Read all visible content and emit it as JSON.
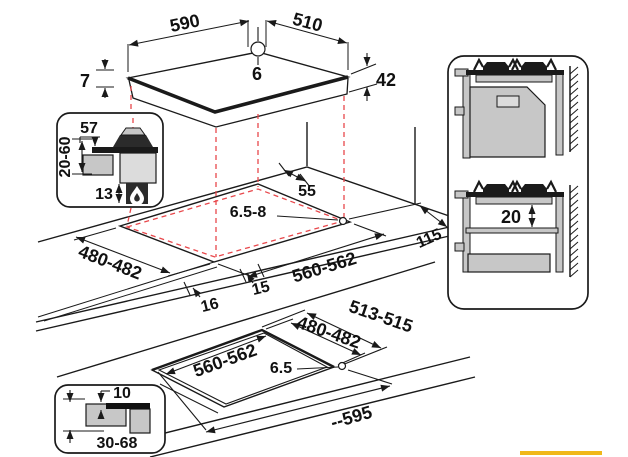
{
  "colors": {
    "line": "#1a1a1a",
    "red_dashed": "#e8474b",
    "fill_gray": "#c7c7c7",
    "fill_light": "#dcdcdc",
    "fill_dark": "#2b2b2b",
    "accent_yellow": "#f0b81a"
  },
  "hob_view": {
    "width": "590",
    "depth": "510",
    "gas_inlet_diameter": "6",
    "rim_thickness": "7",
    "body_height": "42"
  },
  "burner_section_inset": {
    "burner_height": "57",
    "worktop_thickness": "20-60",
    "bottom_clearance": "13",
    "icon": "flame-icon"
  },
  "worktop_view": {
    "rear_gap": "55",
    "fixing_hole": "6.5-8",
    "cutout_depth": "480-482",
    "cutout_width": "560-562",
    "side_gap": "115",
    "front_offset": "15",
    "front_gap": "16"
  },
  "flush_view": {
    "recess_depth": "513-515",
    "cutout_depth": "480-482",
    "cutout_width": "560-562",
    "fixing_hole": "6.5",
    "recess_width": "--595"
  },
  "flush_section_inset": {
    "recess_step": "10",
    "worktop_range": "30-68"
  },
  "cabinet_side_views": {
    "shelf_gap": "20"
  }
}
